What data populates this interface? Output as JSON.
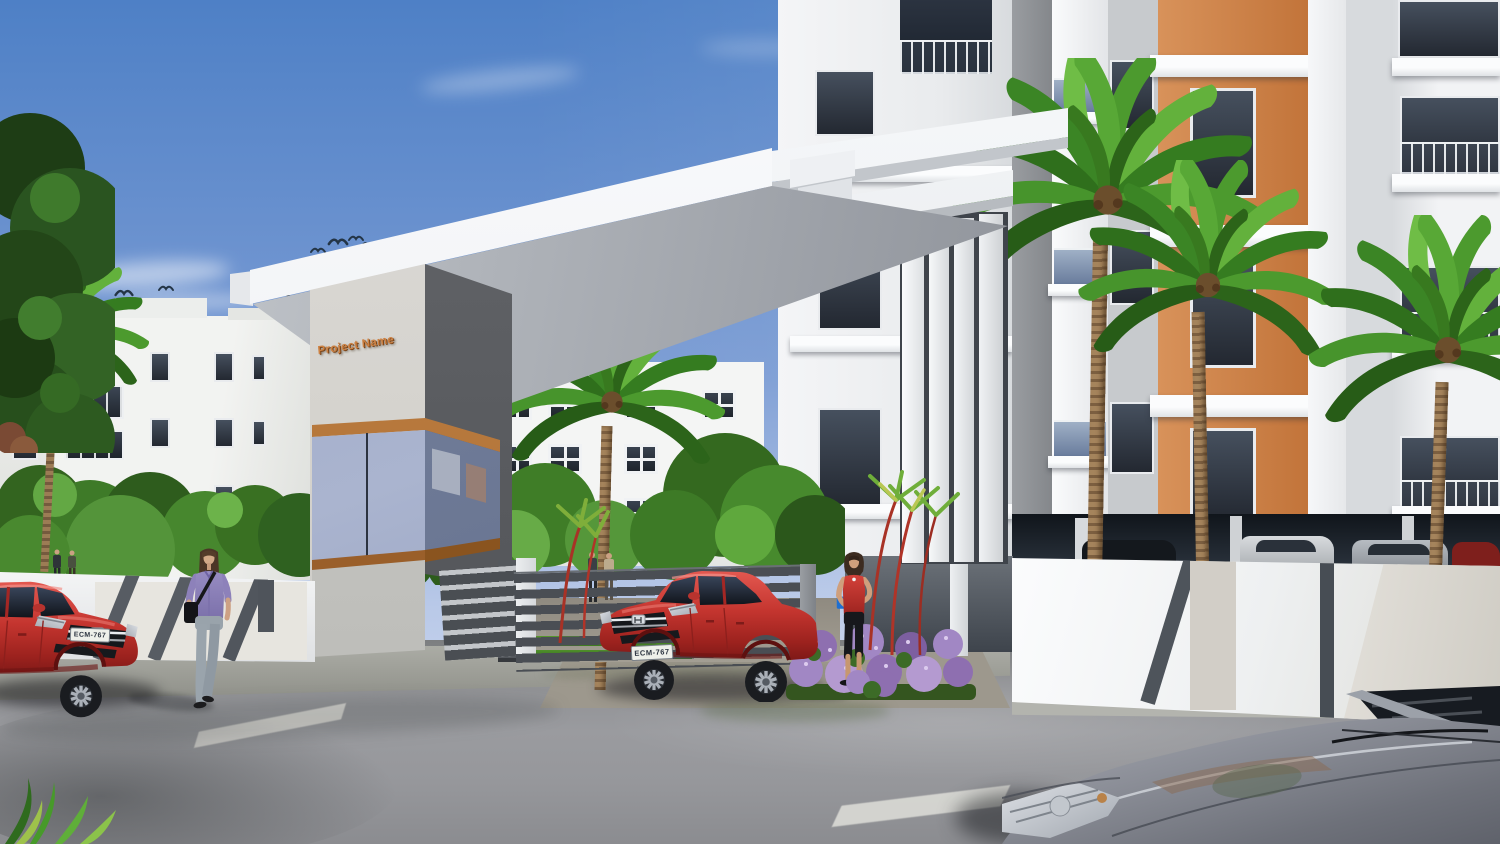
{
  "scene": {
    "kind": "3D architectural rendering",
    "subject": "Apartment complex entrance gate with palm trees, cars and pedestrians"
  },
  "gate": {
    "sign": "Project Name"
  },
  "vehicles": {
    "center_car": {
      "plate": "ECM-767"
    },
    "left_car": {
      "plate": "ECM-767"
    }
  },
  "palette": {
    "sky_top": "#4d7fc7",
    "sky_horizon": "#e2e7f5",
    "canopy_white": "#f4f6f8",
    "pillar_side_gray": "#5d5f63",
    "sign_copper": "#cd8142",
    "wood_trim": "#a5672f",
    "accent_orange": "#cd8049",
    "building_white": "#f0f1f3",
    "wall_stripe_gray": "#565b62",
    "car_red": "#c4352f",
    "foreground_car_gray": "#80838c",
    "palm_green": "#4c9a2e",
    "grass_green": "#4f8f2b",
    "flower_purple": "#a187c4",
    "road_gray": "#94959a"
  }
}
